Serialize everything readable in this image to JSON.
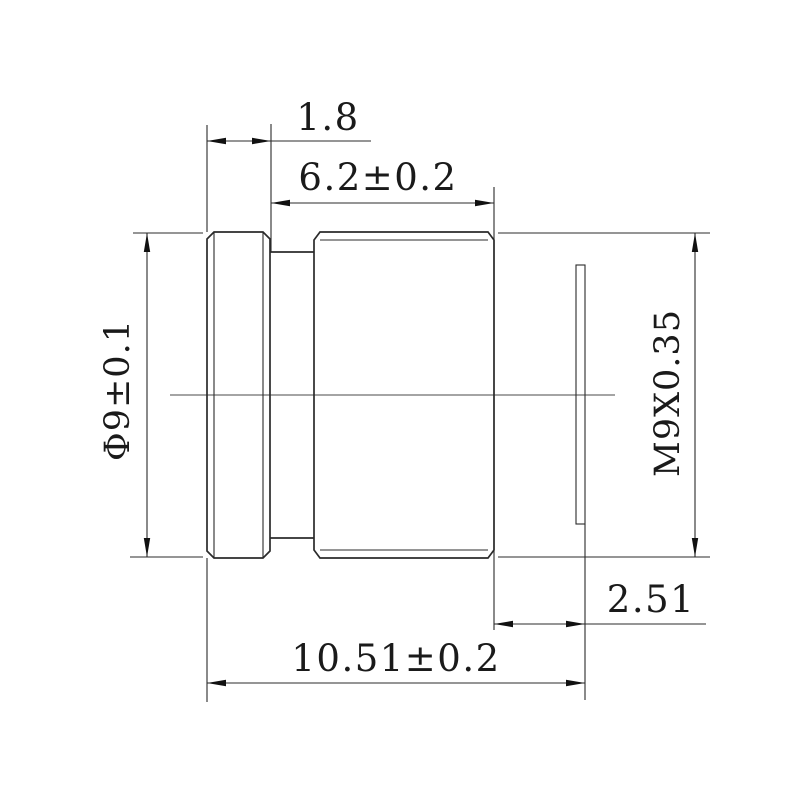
{
  "drawing": {
    "background": "#ffffff",
    "line_color": "#2b2b2b",
    "text_color": "#1a1a1a",
    "dimensions": {
      "front_rim_width": "1.8",
      "thread_length": "6.2±0.2",
      "outer_diameter": "Φ9±0.1",
      "thread_spec": "M9X0.35",
      "rear_protrusion": "2.51",
      "total_length": "10.51±0.2"
    }
  }
}
